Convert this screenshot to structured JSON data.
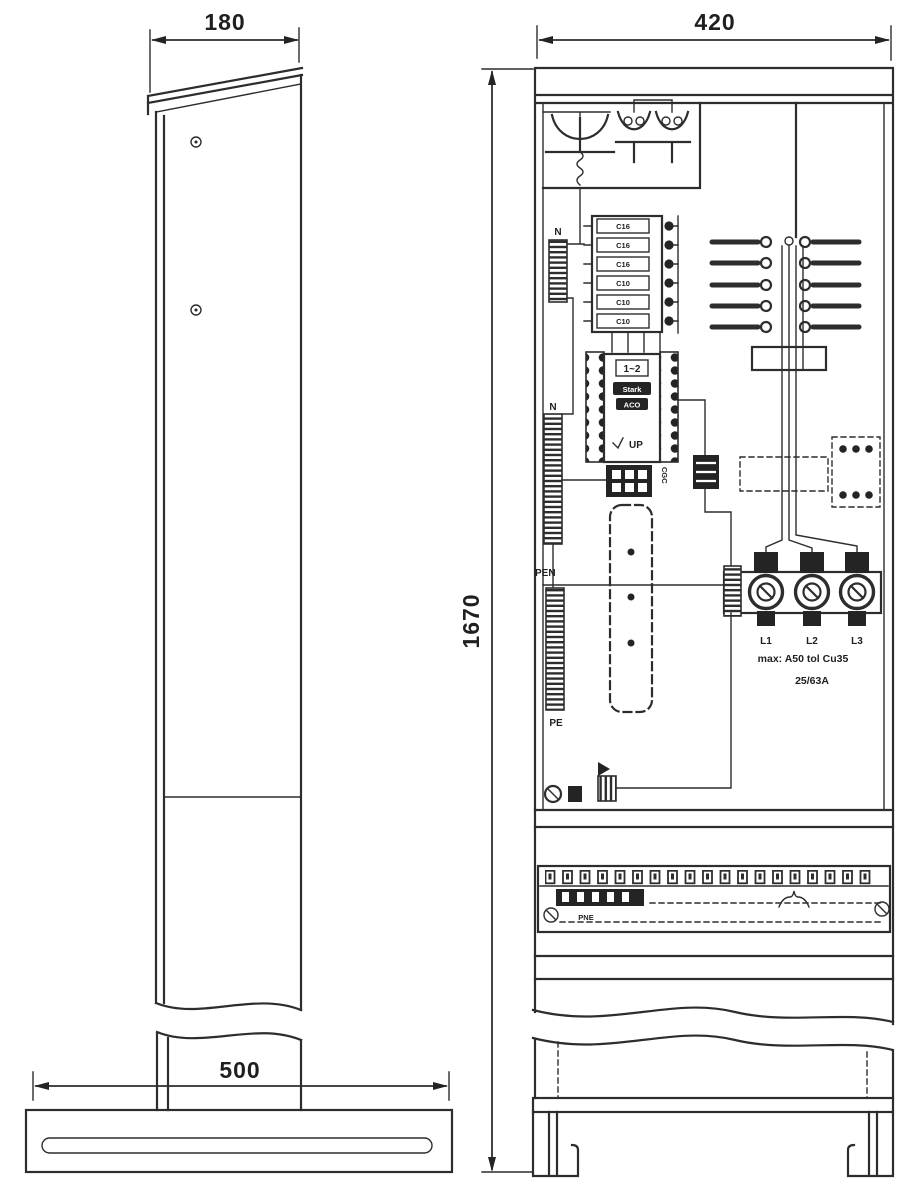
{
  "page": {
    "background": "#ffffff",
    "ink": "#2d2d2d"
  },
  "dimensions": {
    "depth": "180",
    "width": "420",
    "height": "1670",
    "base_width": "500"
  },
  "front_view": {
    "breakers": [
      "C16",
      "C16",
      "C16",
      "C10",
      "C10",
      "C10"
    ],
    "terminals": {
      "n_top": "N",
      "n_mid": "N",
      "pen": "PEN",
      "pe": "PE"
    },
    "contactor": {
      "header": "1~2",
      "row1": "Stark",
      "row2": "ACO",
      "footer": "UP"
    },
    "meter_side_label": "CGC",
    "fuse_group": {
      "phases": [
        "L1",
        "L2",
        "L3"
      ],
      "note_line1": "max: A50 tol Cu35",
      "note_line2": "25/63A"
    },
    "bottom_strip_label": "PNE"
  }
}
